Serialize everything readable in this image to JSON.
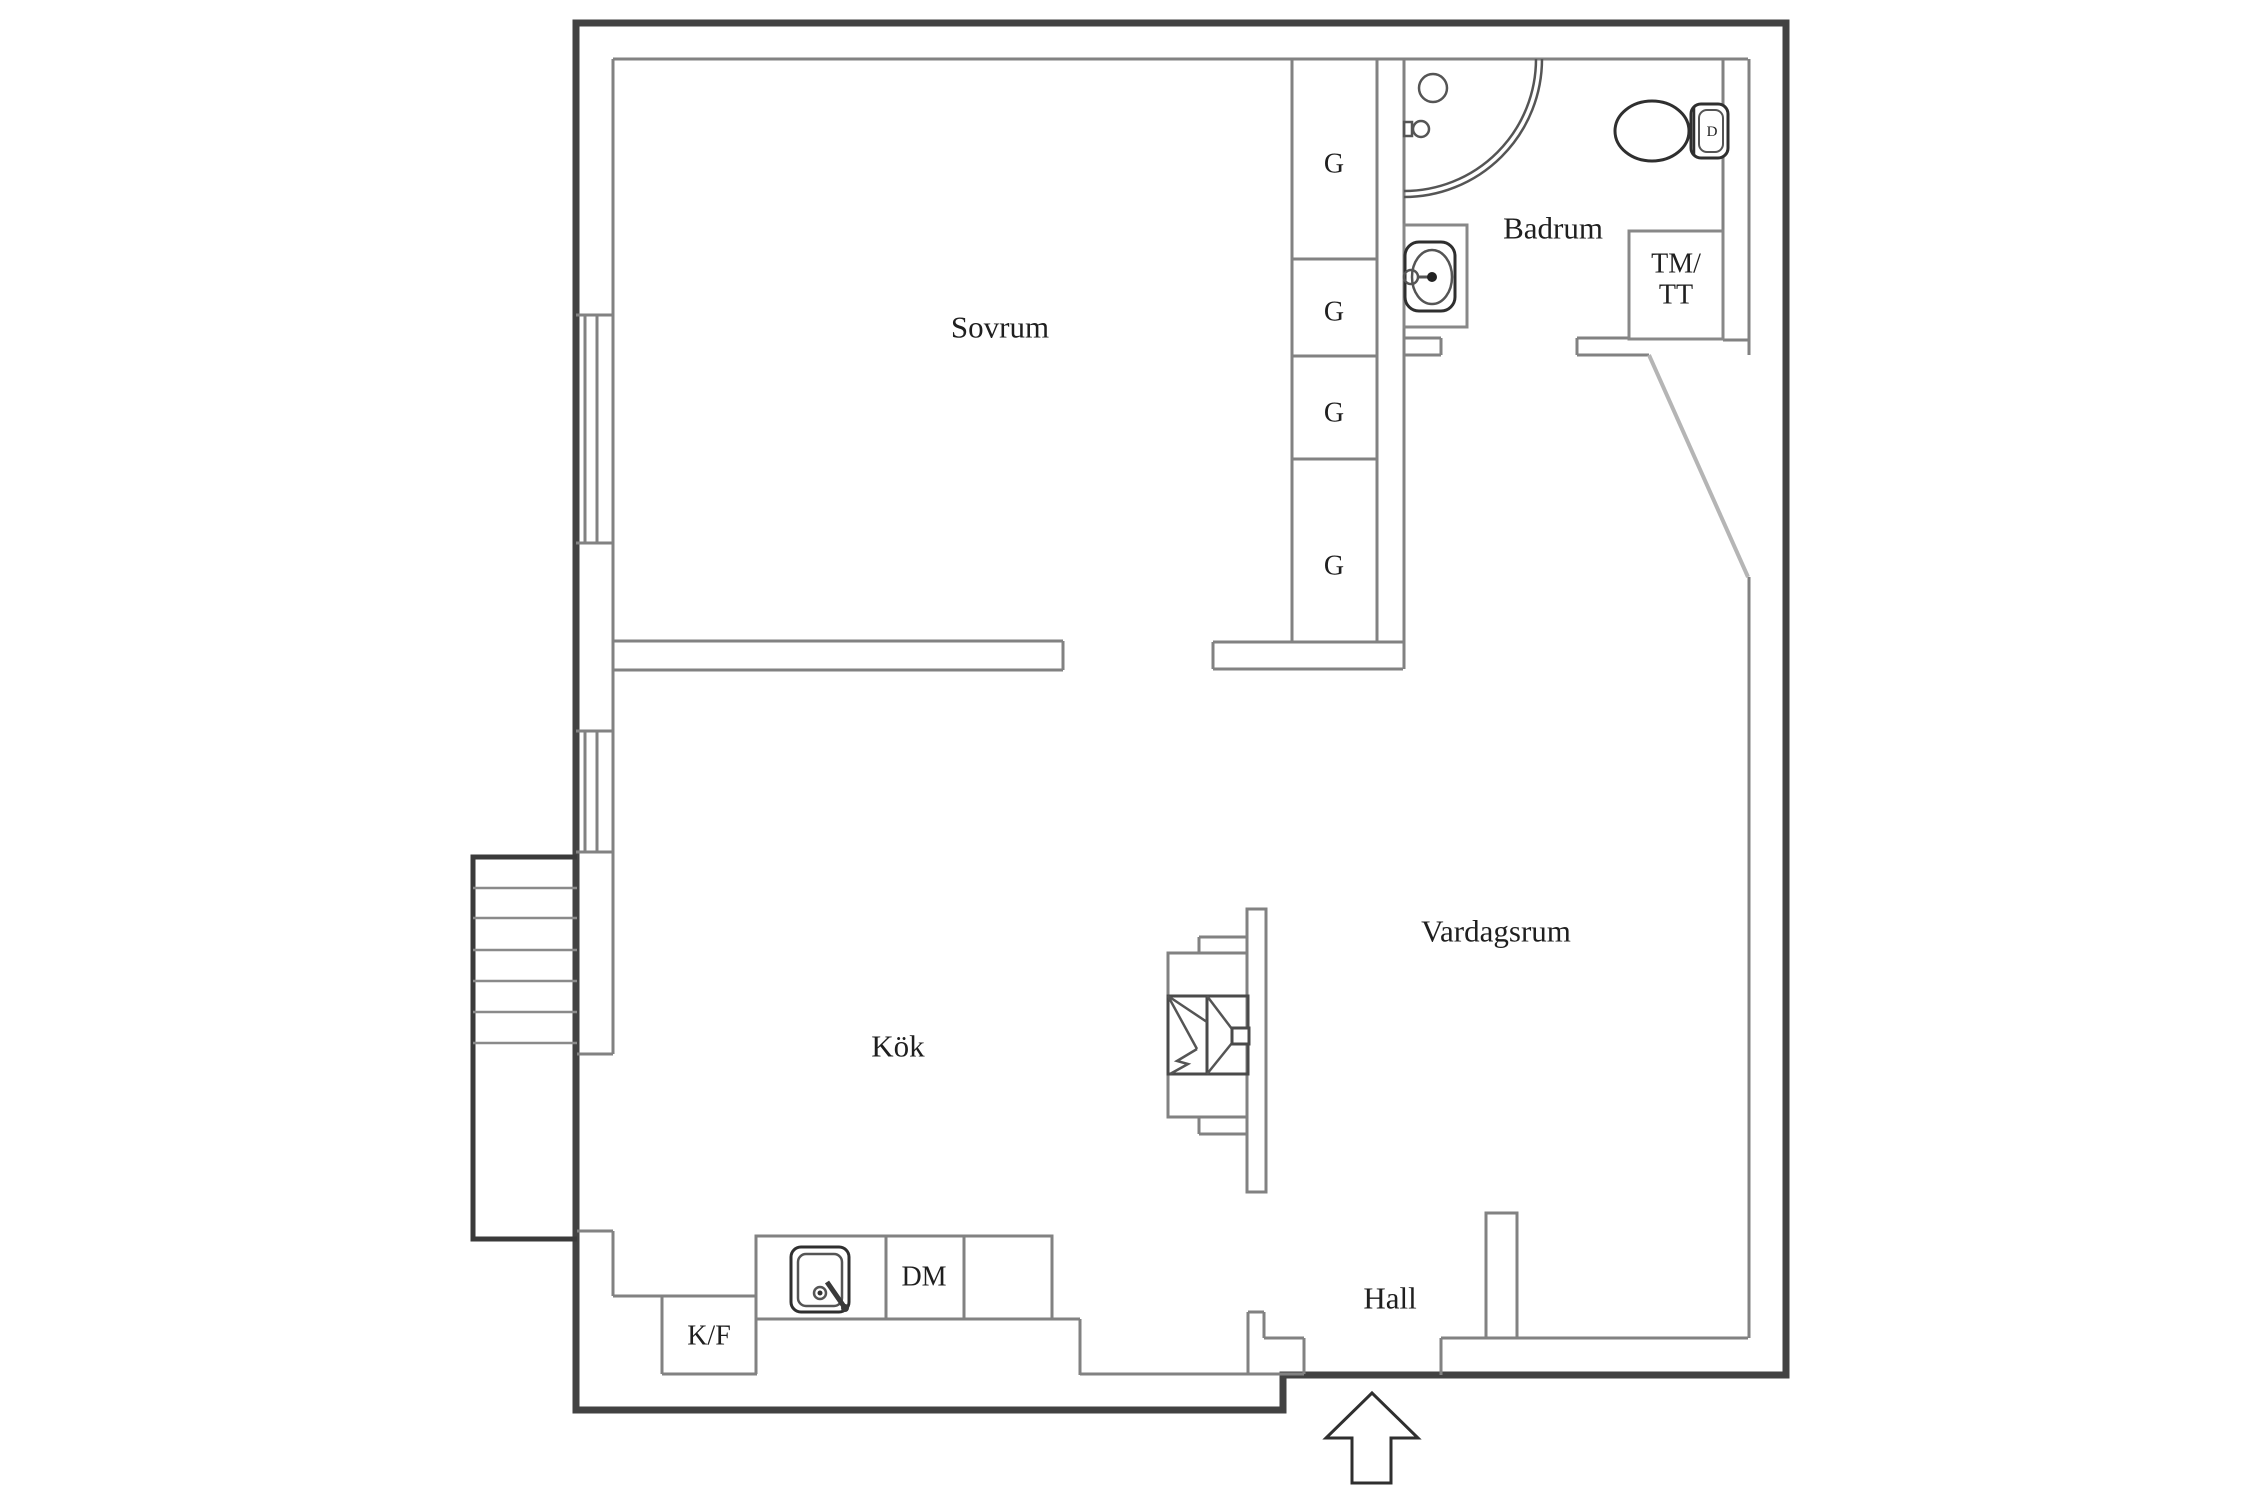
{
  "floorplan": {
    "rooms": {
      "bedroom": "Sovrum",
      "bathroom": "Badrum",
      "kitchen": "Kök",
      "living_room": "Vardagsrum",
      "hall": "Hall"
    },
    "fixtures": {
      "wardrobe": "G",
      "washer_dryer_line1": "TM/",
      "washer_dryer_line2": "TT",
      "dishwasher": "DM",
      "fridge_freezer": "K/F",
      "toilet_button": "D"
    },
    "colors": {
      "wall_outer": "#424242",
      "wall_inner": "#828282",
      "door_leaf": "#b5b5b5",
      "text": "#1f1f1f",
      "background": "#ffffff"
    }
  }
}
